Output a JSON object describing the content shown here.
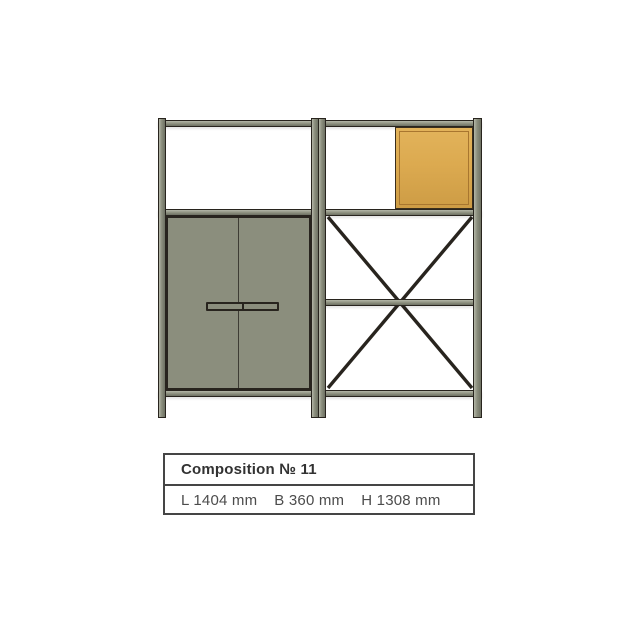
{
  "colors": {
    "background": "#ffffff",
    "frame": "#8b8e7d",
    "frame-light": "#b3b6a7",
    "frame-dark": "#6e7163",
    "door": "#8b8e7d",
    "outline": "#28241e",
    "box-fill": "#dcaa50",
    "box-fill-light": "#e2b35b",
    "box-fill-dark": "#cd9c45",
    "box-border": "#a8762f",
    "box-outline": "#3a2e1c",
    "label-border": "#454545",
    "title-text": "#323232",
    "dims-text": "#4c4c4c"
  },
  "furniture": {
    "description": "Modular shelving composition: open upper compartments, orange storage box, two-door olive cabinet with bar handle, X cross-braced open shelves on the right"
  },
  "label": {
    "title": "Composition № 11",
    "dims": [
      "L 1404 mm",
      "B 360 mm",
      "H 1308 mm"
    ]
  }
}
